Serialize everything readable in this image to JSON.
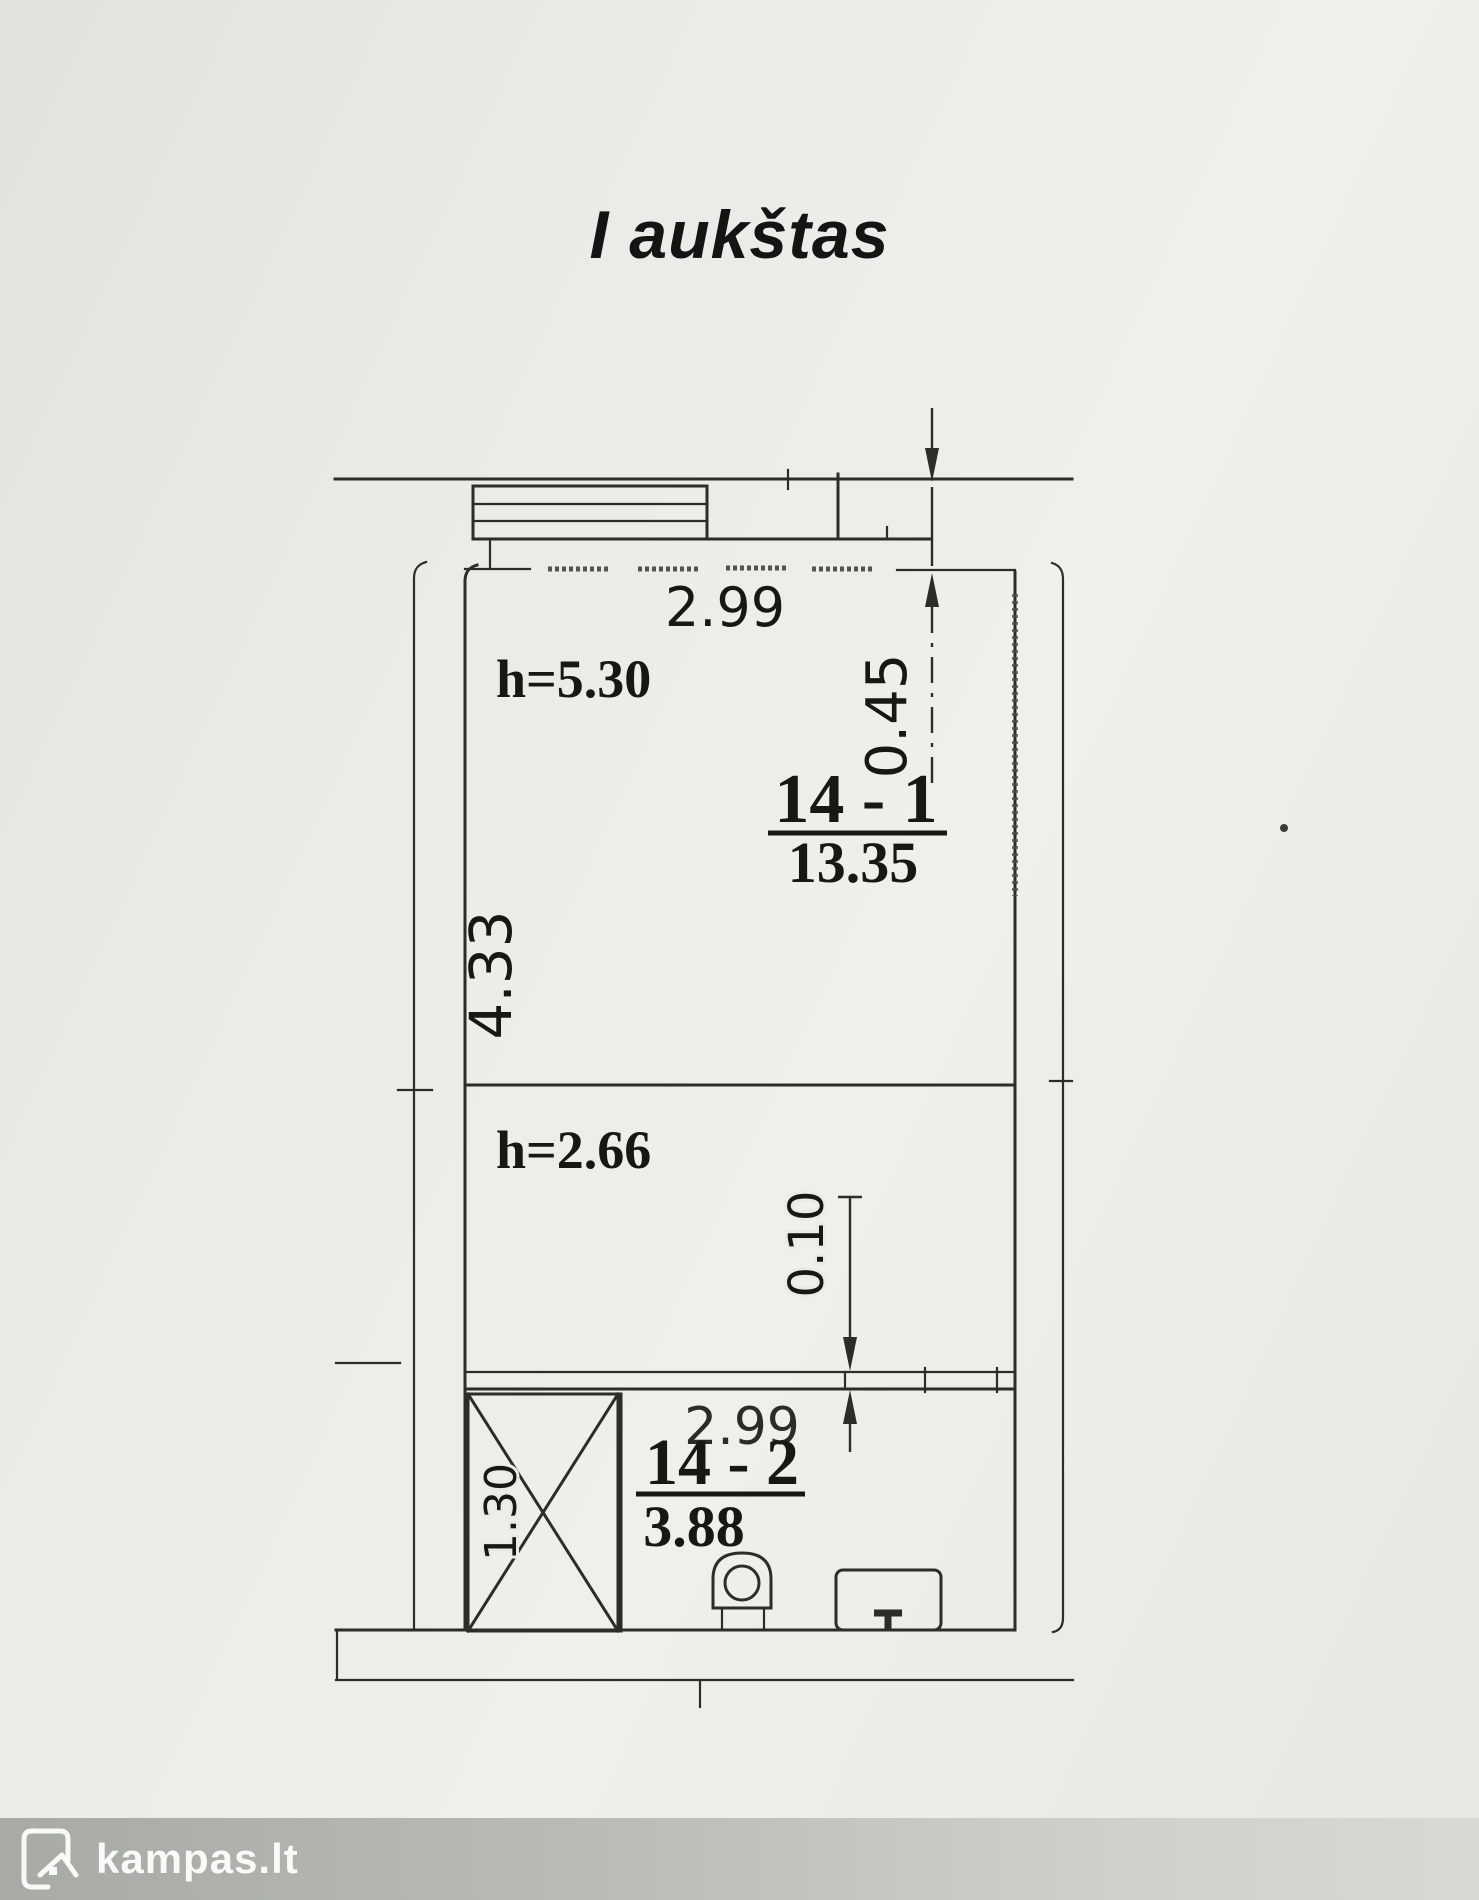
{
  "title": "I aukštas",
  "plan": {
    "dims": {
      "top_width": "2.99",
      "top_offset": "0.45",
      "main_depth": "4.33",
      "wall_gap": "0.10",
      "bath_width": "2.99",
      "bath_depth": "1.30"
    },
    "rooms": {
      "main": {
        "number": "14 - 1",
        "area": "13.35",
        "height": "h=5.30"
      },
      "lower": {
        "height": "h=2.66"
      },
      "bath": {
        "number": "14 - 2",
        "area": "3.88"
      }
    }
  },
  "footer": {
    "logo_text": "kampas.lt"
  }
}
